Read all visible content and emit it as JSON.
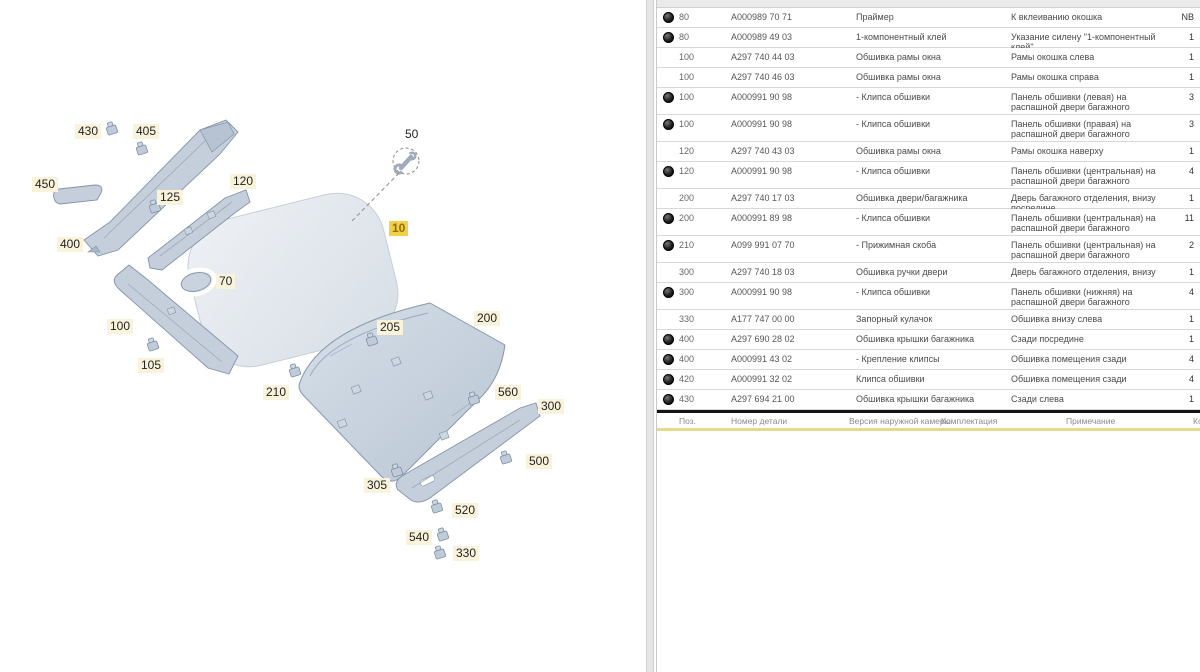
{
  "diagram": {
    "label_bg": "#faf3dc",
    "highlight_color": "#f0cf4a",
    "icons": {
      "tool": "wrench-icon",
      "leader": "dashed-leader-line"
    },
    "labels": [
      {
        "id": "430",
        "x": 75,
        "y": 124
      },
      {
        "id": "405",
        "x": 133,
        "y": 124
      },
      {
        "id": "450",
        "x": 32,
        "y": 177
      },
      {
        "id": "400",
        "x": 57,
        "y": 237
      },
      {
        "id": "125",
        "x": 157,
        "y": 190
      },
      {
        "id": "120",
        "x": 230,
        "y": 174
      },
      {
        "id": "100",
        "x": 107,
        "y": 319
      },
      {
        "id": "105",
        "x": 138,
        "y": 358
      },
      {
        "id": "70",
        "x": 216,
        "y": 274
      },
      {
        "id": "50",
        "x": 402,
        "y": 127,
        "plain": true
      },
      {
        "id": "10",
        "x": 389,
        "y": 221,
        "highlighted": true
      },
      {
        "id": "205",
        "x": 377,
        "y": 320
      },
      {
        "id": "200",
        "x": 474,
        "y": 311
      },
      {
        "id": "210",
        "x": 263,
        "y": 385
      },
      {
        "id": "560",
        "x": 495,
        "y": 385
      },
      {
        "id": "300",
        "x": 538,
        "y": 399
      },
      {
        "id": "500",
        "x": 526,
        "y": 454
      },
      {
        "id": "305",
        "x": 364,
        "y": 478
      },
      {
        "id": "520",
        "x": 452,
        "y": 503
      },
      {
        "id": "540",
        "x": 406,
        "y": 530
      },
      {
        "id": "330",
        "x": 453,
        "y": 546
      }
    ]
  },
  "table": {
    "icons": {
      "row_image": "part-image-icon"
    },
    "accent_yellow": "#e7d88f",
    "rows": [
      {
        "icon": true,
        "pos": "80",
        "part": "A000989 70 71",
        "name": "Праймер",
        "note": "К вклеиванию окошка",
        "qty": "NB"
      },
      {
        "icon": true,
        "pos": "80",
        "part": "A000989 49 03",
        "name": "1-компонентный клей",
        "note": "Указание силену \"1-компонентный клей\"",
        "qty": "1"
      },
      {
        "icon": false,
        "pos": "100",
        "part": "A297 740 44 03",
        "name": "Обшивка рамы окна",
        "note": "Рамы окошка слева",
        "qty": "1"
      },
      {
        "icon": false,
        "pos": "100",
        "part": "A297 740 46 03",
        "name": "Обшивка рамы окна",
        "note": "Рамы окошка справа",
        "qty": "1"
      },
      {
        "icon": true,
        "pos": "100",
        "part": "A000991 90 98",
        "name": "- Клипса обшивки",
        "note": "Панель обшивки (левая) на распашной двери багажного отделения",
        "qty": "3"
      },
      {
        "icon": true,
        "pos": "100",
        "part": "A000991 90 98",
        "name": "- Клипса обшивки",
        "note": "Панель обшивки (правая) на распашной двери багажного отделения",
        "qty": "3"
      },
      {
        "icon": false,
        "pos": "120",
        "part": "A297 740 43 03",
        "name": "Обшивка рамы окна",
        "note": "Рамы окошка наверху",
        "qty": "1"
      },
      {
        "icon": true,
        "pos": "120",
        "part": "A000991 90 98",
        "name": "- Клипса обшивки",
        "note": "Панель обшивки (центральная) на распашной двери багажного отделения",
        "qty": "4"
      },
      {
        "icon": false,
        "pos": "200",
        "part": "A297 740 17 03",
        "name": "Обшивка двери/багажника",
        "note": "Дверь багажного отделения, внизу посредине",
        "qty": "1"
      },
      {
        "icon": true,
        "pos": "200",
        "part": "A000991 89 98",
        "name": "- Клипса обшивки",
        "note": "Панель обшивки (центральная) на распашной двери багажного отделения",
        "qty": "11"
      },
      {
        "icon": true,
        "pos": "210",
        "part": "A099 991 07 70",
        "name": "- Прижимная скоба",
        "note": "Панель обшивки (центральная) на распашной двери багажного отделения",
        "qty": "2"
      },
      {
        "icon": false,
        "pos": "300",
        "part": "A297 740 18 03",
        "name": "Обшивка ручки двери",
        "note": "Дверь багажного отделения, внизу",
        "qty": "1"
      },
      {
        "icon": true,
        "pos": "300",
        "part": "A000991 90 98",
        "name": "- Клипса обшивки",
        "note": "Панель обшивки (нижняя) на распашной двери багажного отделения",
        "qty": "4"
      },
      {
        "icon": false,
        "pos": "330",
        "part": "A177 747 00 00",
        "name": "Запорный кулачок",
        "note": "Обшивка внизу слева",
        "qty": "1"
      },
      {
        "icon": true,
        "pos": "400",
        "part": "A297 690 28 02",
        "name": "Обшивка крышки багажника",
        "note": "Сзади посредине",
        "qty": "1"
      },
      {
        "icon": true,
        "pos": "400",
        "part": "A000991 43 02",
        "name": "- Крепление клипсы",
        "note": "Обшивка помещения сзади",
        "qty": "4"
      },
      {
        "icon": true,
        "pos": "420",
        "part": "A000991 32 02",
        "name": "Клипса обшивки",
        "note": "Обшивка помещения сзади",
        "qty": "4"
      },
      {
        "icon": true,
        "pos": "430",
        "part": "A297 694 21 00",
        "name": "Обшивка крышки багажника",
        "note": "Сзади слева",
        "qty": "1"
      }
    ],
    "footer": {
      "cols": [
        "Поз.",
        "Номер детали",
        "Версия наружной камеры",
        "Комплектация",
        "Примечание",
        "Кол-во"
      ]
    }
  }
}
